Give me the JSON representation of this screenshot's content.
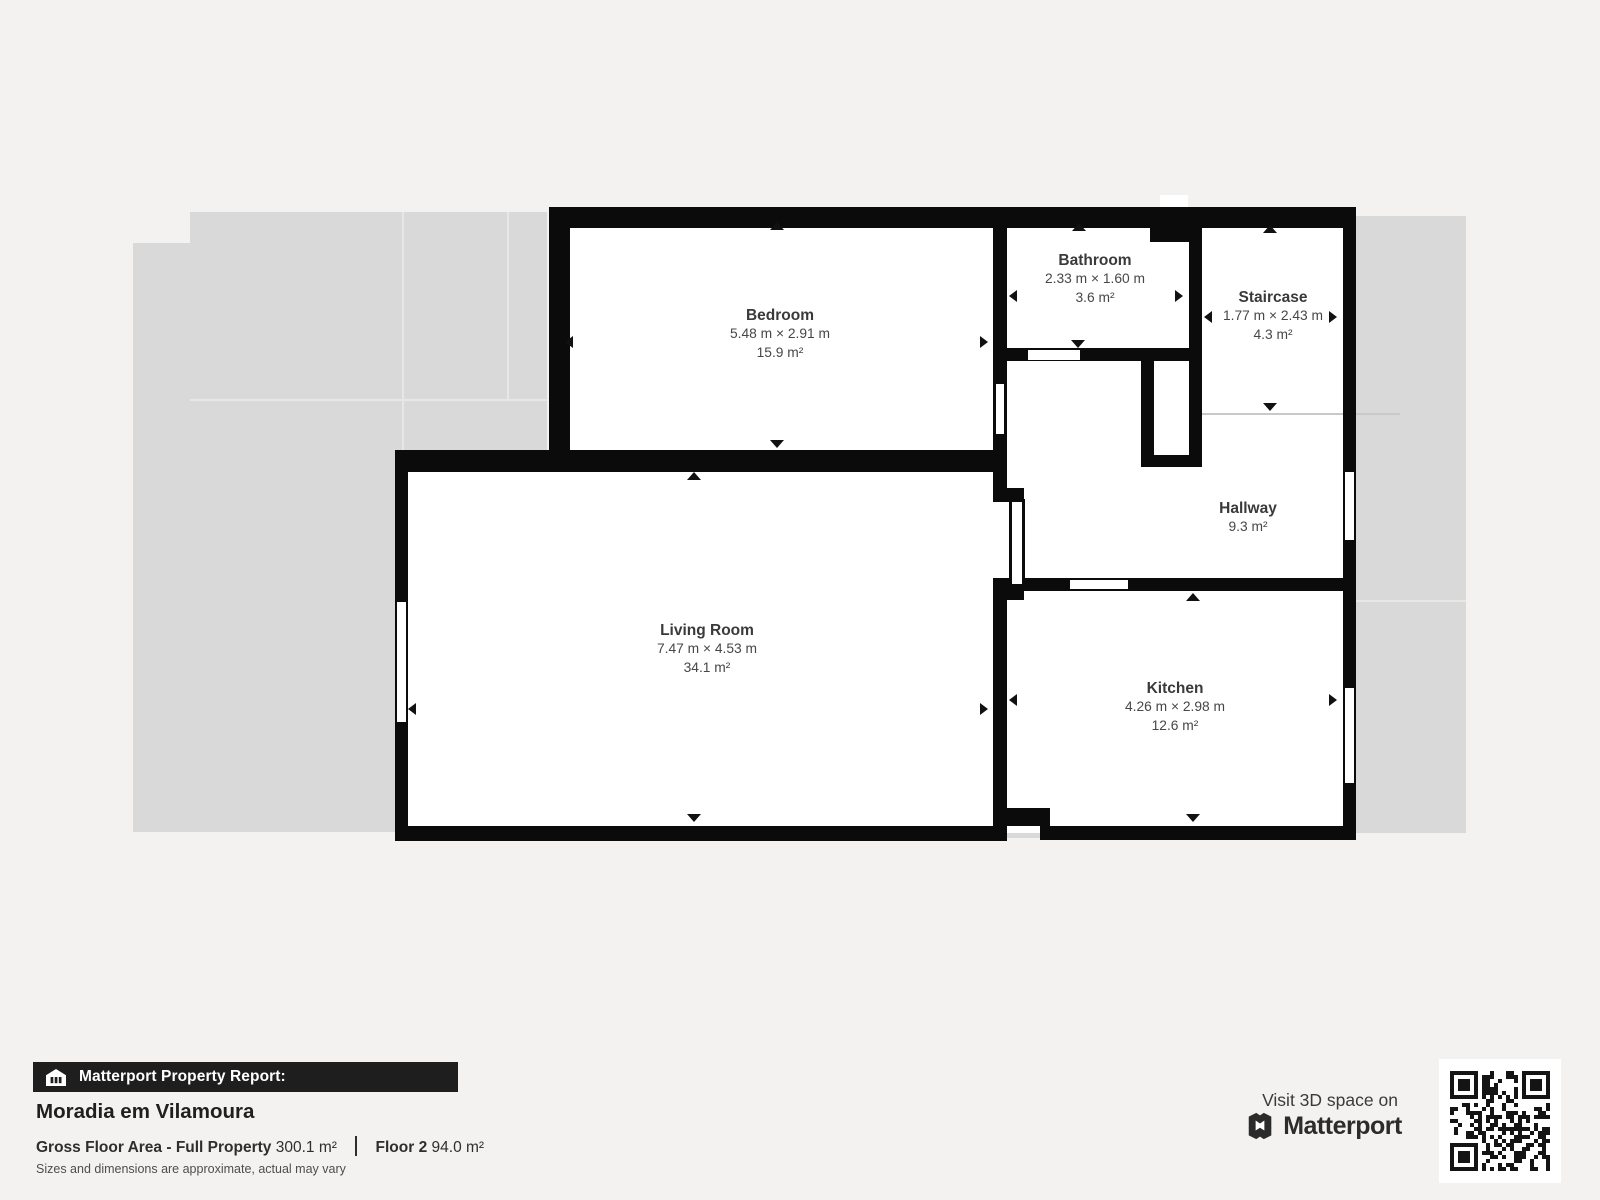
{
  "floorplan": {
    "wall_color": "#0b0b0b",
    "room_fill": "#ffffff",
    "context_fill": "#d9d9d9",
    "rooms": [
      {
        "name": "Bedroom",
        "dimensions": "5.48 m × 2.91 m",
        "area": "15.9 m²"
      },
      {
        "name": "Bathroom",
        "dimensions": "2.33 m × 1.60 m",
        "area": "3.6 m²"
      },
      {
        "name": "Staircase",
        "dimensions": "1.77 m × 2.43 m",
        "area": "4.3 m²"
      },
      {
        "name": "Hallway",
        "area": "9.3 m²"
      },
      {
        "name": "Living Room",
        "dimensions": "7.47 m × 4.53 m",
        "area": "34.1 m²"
      },
      {
        "name": "Kitchen",
        "dimensions": "4.26 m × 2.98 m",
        "area": "12.6 m²"
      }
    ]
  },
  "report": {
    "banner": "Matterport Property Report:",
    "property_name": "Moradia em Vilamoura",
    "gross_floor_area_label": "Gross Floor Area - Full Property",
    "gross_floor_area_value": "300.1 m²",
    "floor_label": "Floor 2",
    "floor_value": "94.0 m²",
    "disclaimer": "Sizes and dimensions are approximate, actual may vary"
  },
  "cta": {
    "visit_label": "Visit 3D space on",
    "brand_name": "Matterport"
  }
}
